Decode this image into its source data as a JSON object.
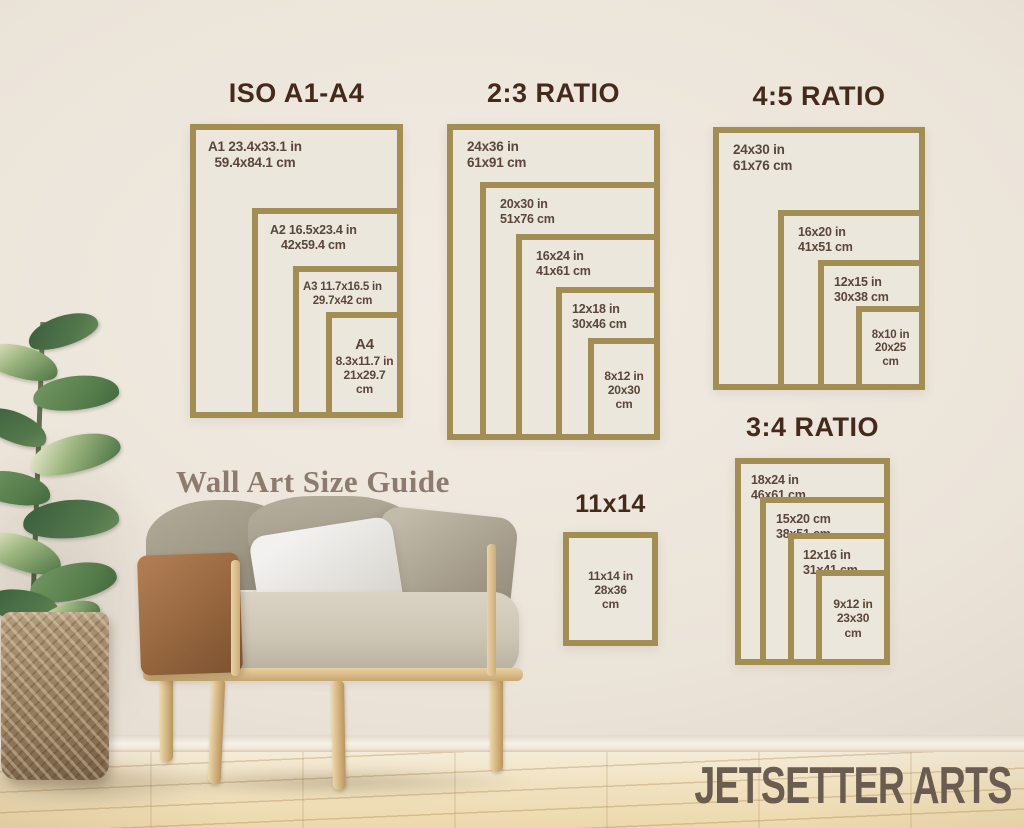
{
  "guide": {
    "title": "Wall Art Size Guide"
  },
  "brand": {
    "name": "JETSETTER ARTS"
  },
  "colors": {
    "frame_gold": "#a28e52",
    "heading_brown": "#45291c",
    "label_brown": "#5a463a",
    "guide_text": "#8c7b6e",
    "brand_text": "#6b5c51"
  },
  "groups": {
    "iso": {
      "title": "ISO A1-A4",
      "frames": [
        {
          "lines": [
            "A1 23.4x33.1 in",
            "59.4x84.1 cm"
          ]
        },
        {
          "lines": [
            "A2 16.5x23.4 in",
            "42x59.4 cm"
          ]
        },
        {
          "lines": [
            "A3 11.7x16.5 in",
            "29.7x42 cm"
          ]
        },
        {
          "lines": [
            "A4",
            "8.3x11.7 in",
            "21x29.7",
            "cm"
          ]
        }
      ]
    },
    "ratio23": {
      "title": "2:3 RATIO",
      "frames": [
        {
          "lines": [
            "24x36 in",
            "61x91 cm"
          ]
        },
        {
          "lines": [
            "20x30 in",
            "51x76 cm"
          ]
        },
        {
          "lines": [
            "16x24 in",
            "41x61 cm"
          ]
        },
        {
          "lines": [
            "12x18 in",
            "30x46 cm"
          ]
        },
        {
          "lines": [
            "8x12 in",
            "20x30",
            "cm"
          ]
        }
      ]
    },
    "ratio45": {
      "title": "4:5 RATIO",
      "frames": [
        {
          "lines": [
            "24x30 in",
            "61x76 cm"
          ]
        },
        {
          "lines": [
            "16x20 in",
            "41x51 cm"
          ]
        },
        {
          "lines": [
            "12x15 in",
            "30x38 cm"
          ]
        },
        {
          "lines": [
            "8x10 in",
            "20x25",
            "cm"
          ]
        }
      ]
    },
    "ratio34": {
      "title": "3:4 RATIO",
      "frames": [
        {
          "lines": [
            "18x24 in",
            "46x61 cm"
          ]
        },
        {
          "lines": [
            "15x20 cm",
            "38x51 cm"
          ]
        },
        {
          "lines": [
            "12x16 in",
            "31x41 cm"
          ]
        },
        {
          "lines": [
            "9x12 in",
            "23x30",
            "cm"
          ]
        }
      ]
    },
    "single1114": {
      "title": "11x14",
      "frames": [
        {
          "lines": [
            "11x14 in",
            "28x36",
            "cm"
          ]
        }
      ]
    }
  }
}
